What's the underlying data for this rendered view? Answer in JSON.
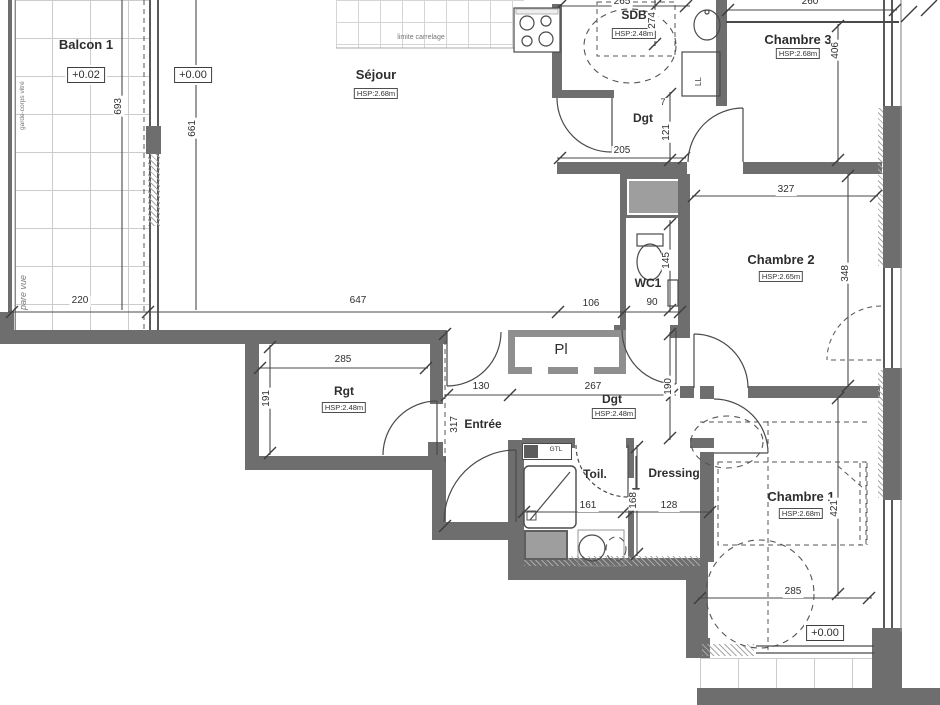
{
  "title": "Plan d'appartement",
  "colors": {
    "wall": "#6e6e6e",
    "wall_light": "#9e9e9e",
    "line": "#4a4a4a",
    "dash": "#555555",
    "grid": "#cccccc",
    "text": "#2e2e2e",
    "muted": "#777777"
  },
  "rooms": {
    "balcon1": {
      "name": "Balcon 1",
      "level": "+0.02"
    },
    "sejour": {
      "name": "Séjour",
      "hsp": "HSP:2.68m",
      "level": "+0.00"
    },
    "sdb": {
      "name": "SDB",
      "hsp": "HSP:2.48m"
    },
    "chambre3": {
      "name": "Chambre 3",
      "hsp": "HSP:2.68m"
    },
    "dgt_haut": {
      "name": "Dgt"
    },
    "wc1": {
      "name": "WC1"
    },
    "chambre2": {
      "name": "Chambre 2",
      "hsp": "HSP:2.65m"
    },
    "rgt": {
      "name": "Rgt",
      "hsp": "HSP:2.48m"
    },
    "entree": {
      "name": "Entrée"
    },
    "placard": {
      "name": "Pl"
    },
    "dgt_bas": {
      "name": "Dgt",
      "hsp": "HSP:2.48m"
    },
    "toil": {
      "name": "Toil."
    },
    "dressing": {
      "name": "Dressing"
    },
    "chambre1": {
      "name": "Chambre 1",
      "hsp": "HSP:2.68m",
      "level": "+0.00"
    }
  },
  "annotations": {
    "garde_corps": "garde-corps vitré",
    "pare_vue": "pare vue",
    "limite_carrelage": "limite carrelage",
    "lave_linge": "LL",
    "gtl": "GTL"
  },
  "dims": {
    "balcon_h": "693",
    "sejour_h": "661",
    "balcon_w": "220",
    "sejour_w": "647",
    "hall_w": "106",
    "wc1_w": "90",
    "sdb_w": "265",
    "sdb_h": "274",
    "ch3_w": "260",
    "ch3_h": "406",
    "dgt1_w": "205",
    "dgt1_h": "121",
    "dgt1_step": "7",
    "ch2_w": "327",
    "ch2_h": "348",
    "wc1_h": "145",
    "rgt_w": "285",
    "rgt_h": "191",
    "entree_w": "130",
    "dgt2_w": "267",
    "entree_h": "317",
    "dgt2_h": "190",
    "toil_w": "161",
    "dressing_h": "168",
    "dressing_w": "128",
    "ch1_h": "421",
    "ch1_w": "285"
  }
}
